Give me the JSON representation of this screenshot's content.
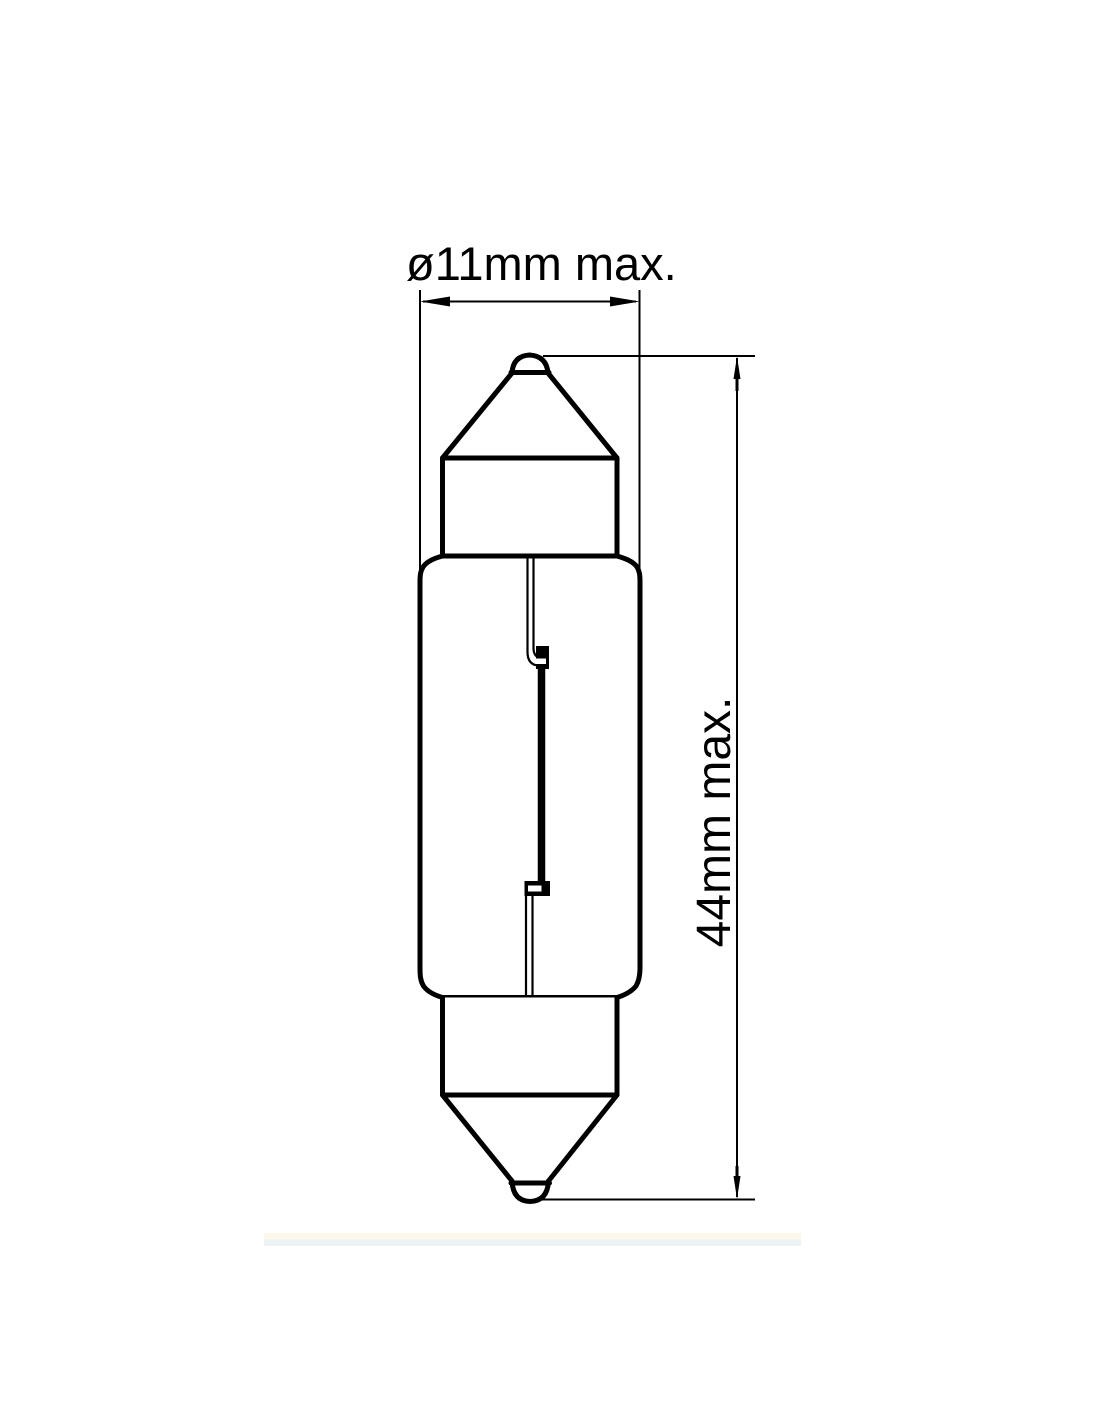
{
  "diagram": {
    "type": "technical-drawing",
    "subject": "festoon-bulb-dimension-drawing",
    "dimensions": [
      {
        "name": "diameter",
        "label": "ø11mm max.",
        "value_mm": 11
      },
      {
        "name": "length",
        "label": "44mm max.",
        "value_mm": 44
      }
    ],
    "colors": {
      "line": "#000000",
      "background": "#ffffff"
    }
  }
}
